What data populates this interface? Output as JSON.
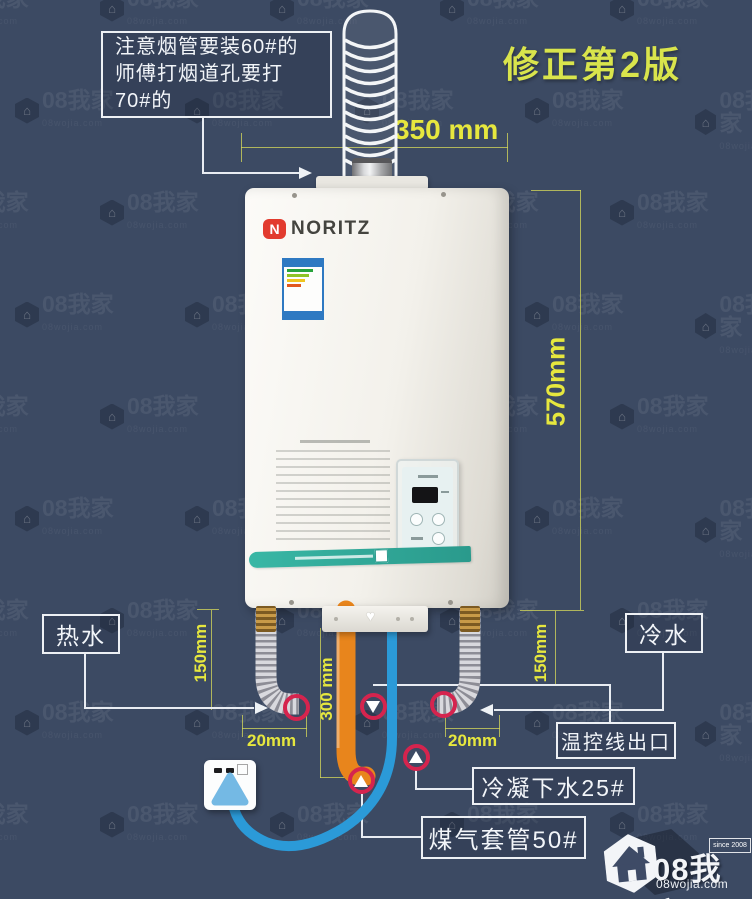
{
  "note": {
    "line1": "注意烟管要装60#的",
    "line2": "师傅打烟道孔要打",
    "line3": "70#的"
  },
  "revision": "修正第2版",
  "dims": {
    "width_top": "350 mm",
    "height_right": "570mm",
    "left_drop": "150mm",
    "right_drop": "150mm",
    "gap_left": "20mm",
    "gap_right": "20mm",
    "center_drop": "300 mm"
  },
  "labels": {
    "hot": "热水",
    "cold": "冷水",
    "thermostat": "温控线出口",
    "condensate": "冷凝下水25#",
    "gas": "煤气套管50#"
  },
  "heater": {
    "brand": "NORITZ",
    "brand_initial": "N"
  },
  "watermark": {
    "name": "08我家",
    "domain": "08wojia.com",
    "house_glyph": "⌂"
  },
  "logo": {
    "name": "08我家",
    "domain": "08wojia.com",
    "since": "since 2008",
    "house_glyph": "⌂"
  },
  "colors": {
    "background": "#3c4a63",
    "dim_yellow": "#e6e73e",
    "revision_yellow": "#dce24b",
    "pipe_orange": "#e8851c",
    "pipe_blue": "#2b9ad8",
    "marker_red": "#d5244e",
    "band_teal": "#2fa99b",
    "brand_red": "#e23b2e"
  }
}
